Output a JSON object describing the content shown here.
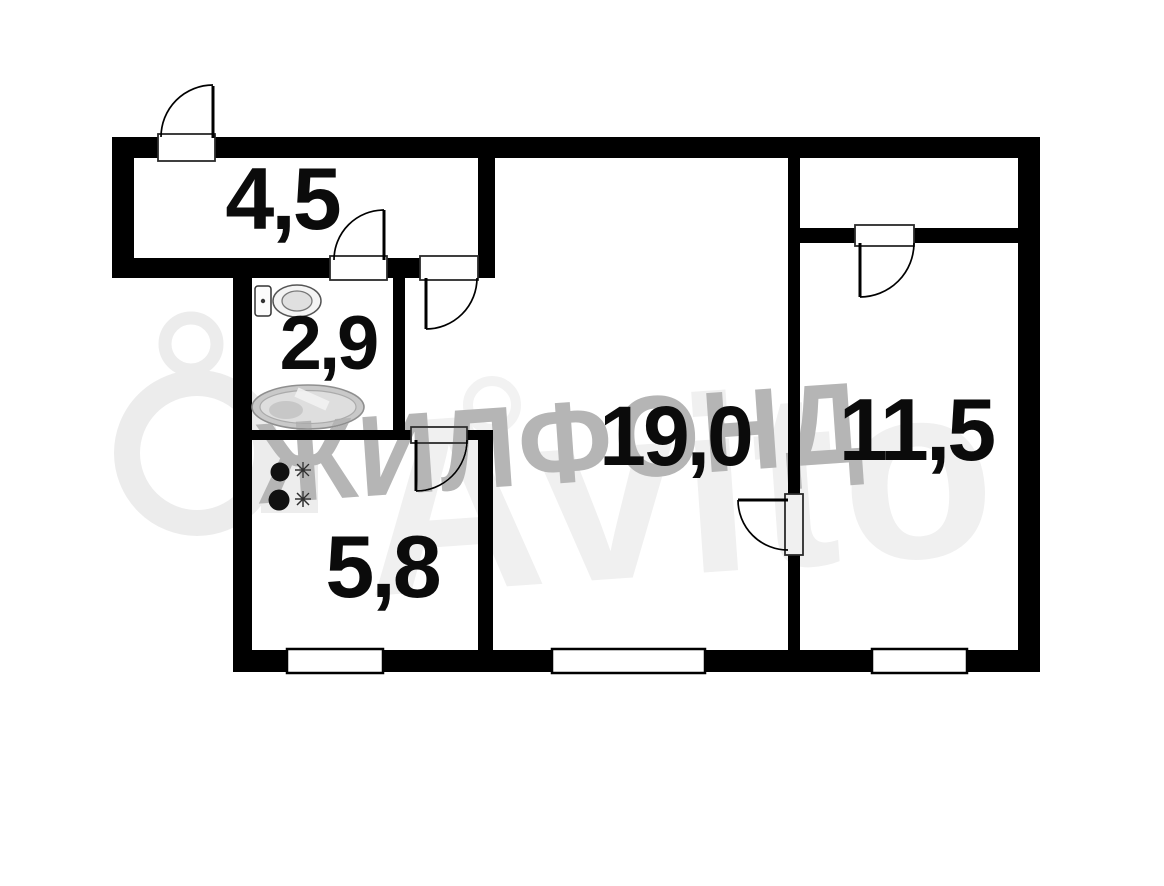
{
  "plan": {
    "type": "apartment-floorplan",
    "rooms": [
      {
        "name": "hallway",
        "area_label": "4,5"
      },
      {
        "name": "bathroom",
        "area_label": "2,9"
      },
      {
        "name": "kitchen",
        "area_label": "5,8"
      },
      {
        "name": "living-room",
        "area_label": "19,0"
      },
      {
        "name": "bedroom",
        "area_label": "11,5"
      }
    ],
    "fixtures": [
      {
        "icon": "toilet-icon",
        "room": "bathroom"
      },
      {
        "icon": "bathtub-icon",
        "room": "bathroom"
      },
      {
        "icon": "stove-icon",
        "room": "kitchen"
      }
    ],
    "features": {
      "doors": 6,
      "windows": 3,
      "closet": "top of bedroom"
    },
    "watermarks": {
      "primary": "ЖИЛФОНД",
      "secondary": "Avito"
    },
    "colors": {
      "wall": "#000000",
      "room_fill": "#ffffff",
      "label": "#0b0b0b",
      "watermark_primary": "#b5b5b5",
      "watermark_secondary": "#f0f0f0"
    }
  }
}
